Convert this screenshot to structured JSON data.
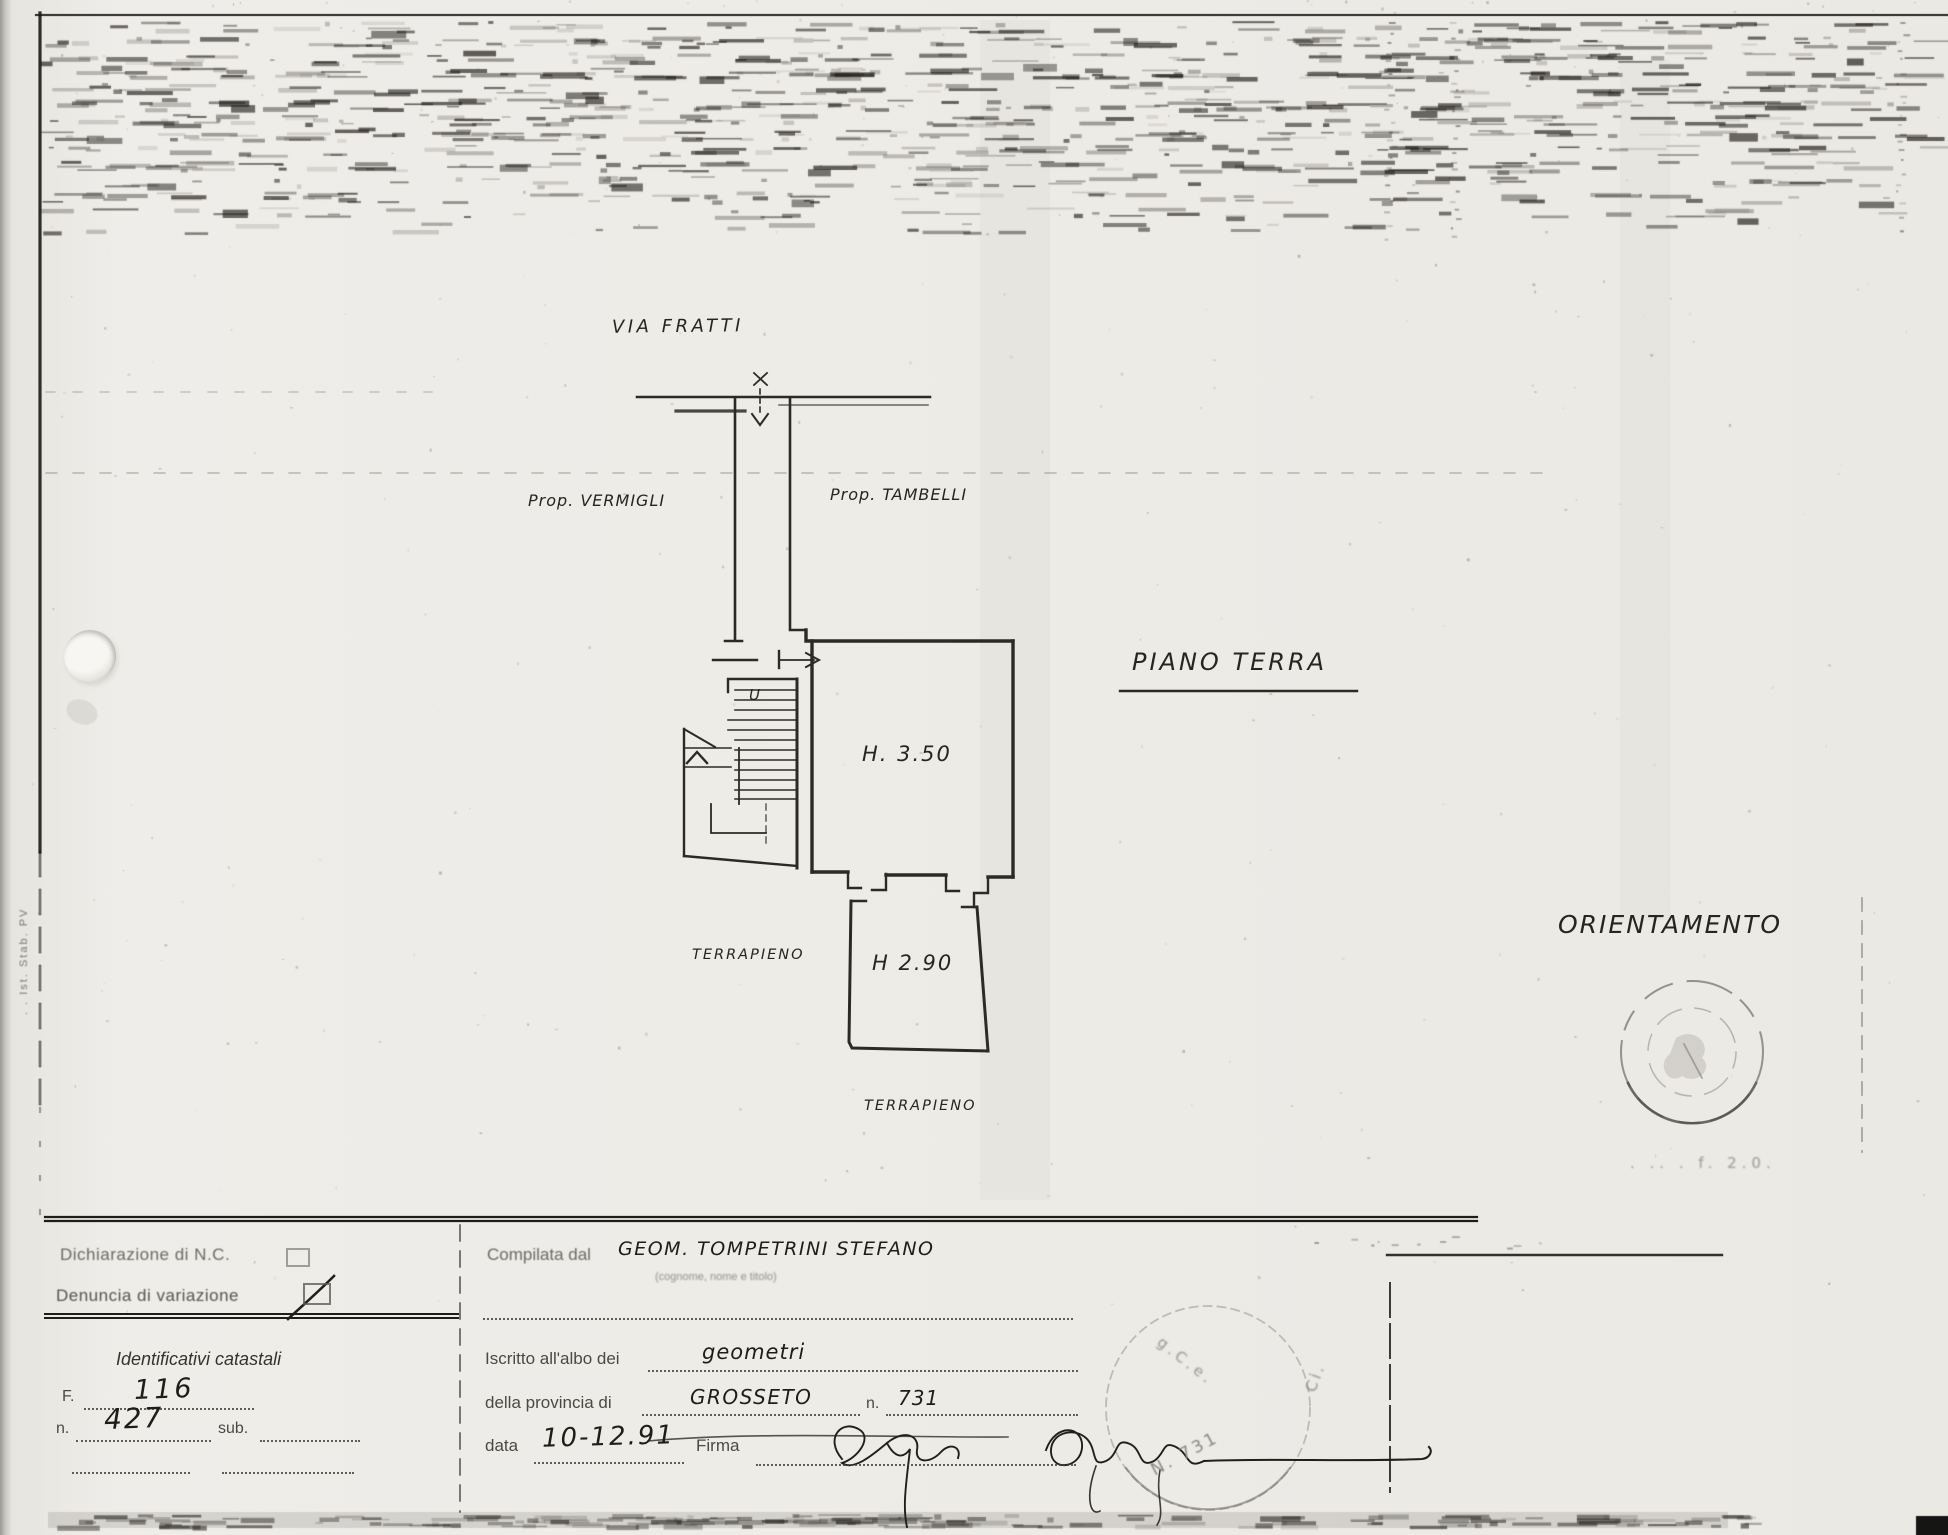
{
  "colors": {
    "paper": "#edebe6",
    "ink": "#23231e",
    "faint_ink": "#8a8881"
  },
  "plan": {
    "street_name": "VIA FRATTI",
    "prop_left": "Prop. VERMIGLI",
    "prop_right": "Prop. TAMBELLI",
    "floor_title": "PIANO TERRA",
    "height_main": "H. 3.50",
    "height_lower": "H 2.90",
    "terrain_left": "TERRAPIENO",
    "terrain_bottom": "TERRAPIENO",
    "stair_mark": "U",
    "orientation_title": "ORIENTAMENTO",
    "scale_note": ". .. . f. 2.0."
  },
  "margin_note": ". . Ist. Stab. PV",
  "form": {
    "declaration_label": "Dichiarazione di N.C.",
    "variation_label": "Denuncia di variazione",
    "identifiers_title": "Identificativi catastali",
    "f_label": "F.",
    "f_value": "116",
    "n_label": "n.",
    "n_value": "427",
    "sub_label": "sub.",
    "compiled_label": "Compilata dal",
    "compiled_value": "GEOM. TOMPETRINI STEFANO",
    "compiled_hint": "(cognome, nome e titolo)",
    "register_label": "Iscritto all'albo dei",
    "register_value": "geometri",
    "province_label": "della provincia di",
    "province_value": "GROSSETO",
    "number_label": "n.",
    "number_value": "731",
    "date_label": "data",
    "date_value": "10-12.91",
    "sign_label": "Firma",
    "stamp_number": "N. 731",
    "stamp_frag_mid": "g.C.e.",
    "stamp_frag_top": "Ci."
  }
}
